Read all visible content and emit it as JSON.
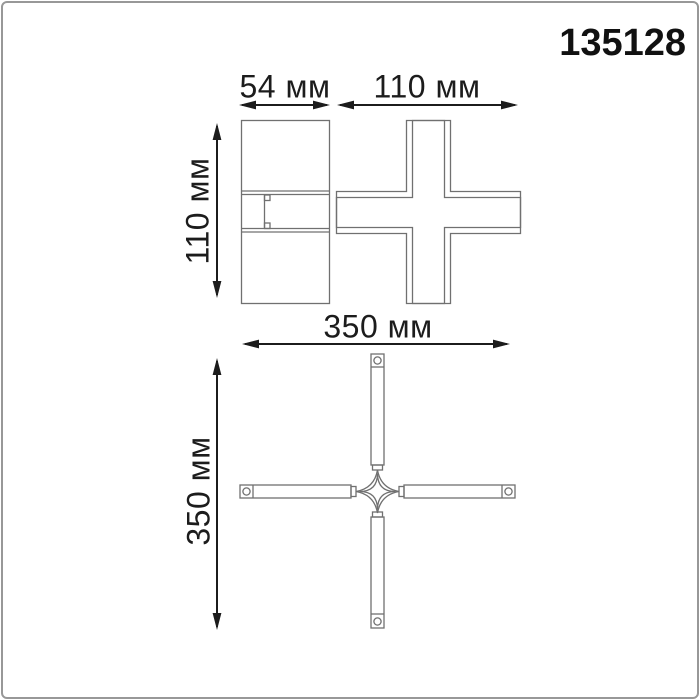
{
  "product_code": "135128",
  "units": "мм",
  "colors": {
    "background": "#ffffff",
    "frame_border": "#989898",
    "drawing_line": "#707070",
    "dimension_ink": "#1c1c1c"
  },
  "dimension_labels": {
    "side_width": "54 мм",
    "front_width": "110 мм",
    "front_height": "110 мм",
    "plan_width": "350 мм",
    "plan_height": "350 мм"
  },
  "dimensions_mm": {
    "side_width": 54,
    "front_width": 110,
    "front_height": 110,
    "plan_width": 350,
    "plan_height": 350
  },
  "views": [
    {
      "id": "side-view",
      "label_refs": [
        "side_width",
        "front_height"
      ]
    },
    {
      "id": "cross-front-view",
      "label_refs": [
        "front_width",
        "front_height"
      ]
    },
    {
      "id": "x-connector-plan-view",
      "label_refs": [
        "plan_width",
        "plan_height"
      ]
    }
  ]
}
